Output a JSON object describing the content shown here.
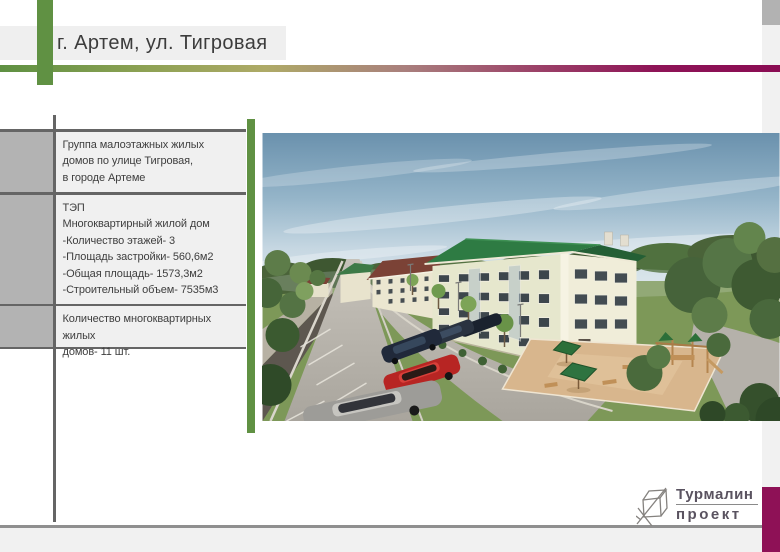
{
  "header": {
    "title": "г. Артем, ул. Тигровая"
  },
  "info_table": {
    "rows": [
      {
        "text": "Группа малоэтажных жилых\nдомов по улице Тигровая,\nв городе Артеме"
      },
      {
        "text": "ТЭП\n Многоквартирный жилой дом\n-Количество этажей- 3\n-Площадь застройки- 560,6м2\n-Общая площадь- 1573,3м2\n-Строительный объем- 7535м3"
      },
      {
        "text": "Количество многоквартирных жилых\nдомов- 11 шт."
      }
    ]
  },
  "render": {
    "alt": "3D визуализация: группа малоэтажных жилых домов с зелёными крышами, улица с парковкой, автомобили и детская площадка"
  },
  "logo": {
    "name": "Турмалин",
    "subtitle": "проект",
    "icon": "sketch-cube-icon"
  },
  "colors": {
    "accent_green": "#609143",
    "accent_magenta": "#8e1156",
    "gradient_left": "#5e9042",
    "gradient_right": "#8a0c53",
    "table_block_gray": "#b3b3b3",
    "table_line_gray": "#656565",
    "panel_gray": "#f0f0f0",
    "footer_gray": "#f1f1f1"
  }
}
